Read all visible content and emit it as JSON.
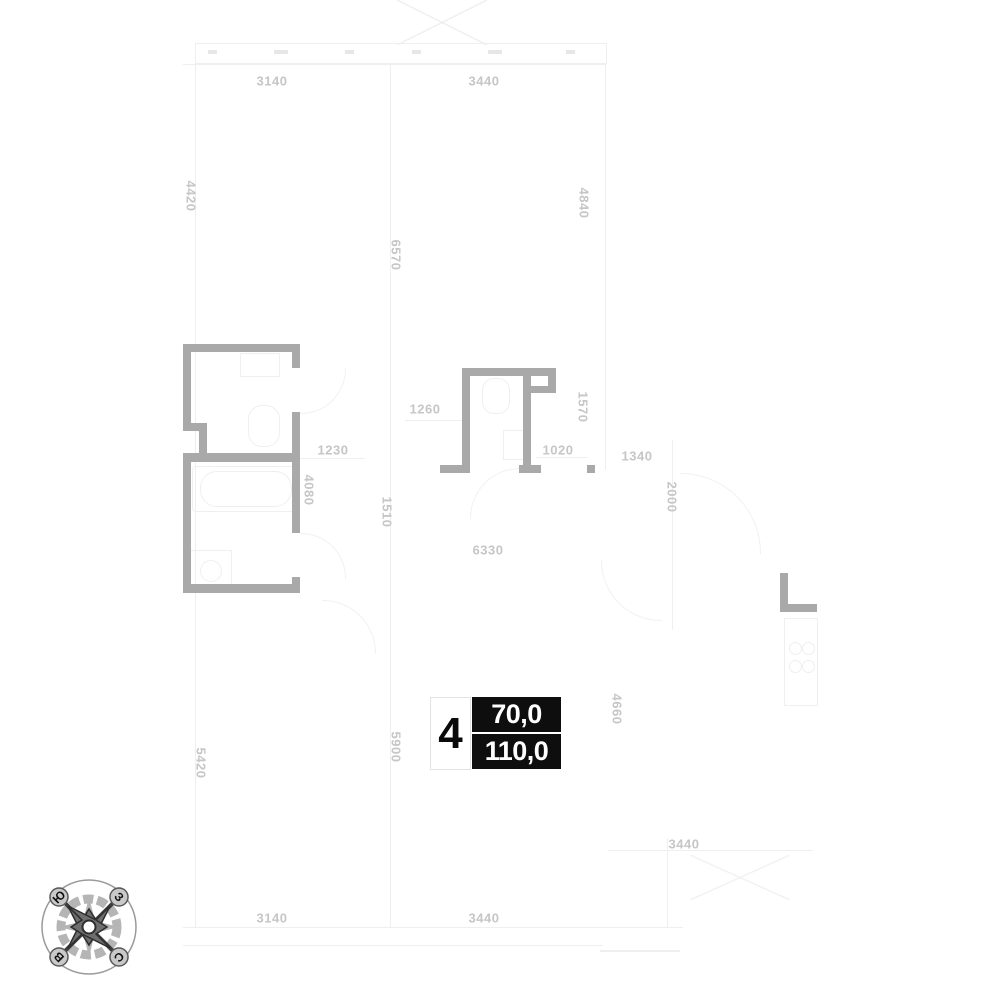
{
  "plan": {
    "type": "apartment-floor-plan",
    "badge": {
      "number": "4",
      "area_top": "70,0",
      "area_bottom": "110,0"
    },
    "wall_color": "#a9a9a9",
    "dimension_text_color": "#c6c6c6"
  },
  "compass": {
    "top_left": "Ю",
    "top_right": "З",
    "bottom_left": "В",
    "bottom_right": "С"
  },
  "dimensions": [
    {
      "text": "3140",
      "x": 272,
      "y": 81,
      "rot": 0
    },
    {
      "text": "3440",
      "x": 484,
      "y": 81,
      "rot": 0
    },
    {
      "text": "4420",
      "x": 191,
      "y": 196,
      "rot": 90
    },
    {
      "text": "4840",
      "x": 584,
      "y": 203,
      "rot": 90
    },
    {
      "text": "6570",
      "x": 396,
      "y": 255,
      "rot": 90
    },
    {
      "text": "1260",
      "x": 425,
      "y": 409,
      "rot": 0
    },
    {
      "text": "1570",
      "x": 583,
      "y": 407,
      "rot": 90
    },
    {
      "text": "1230",
      "x": 333,
      "y": 450,
      "rot": 0
    },
    {
      "text": "1020",
      "x": 558,
      "y": 450,
      "rot": 0
    },
    {
      "text": "1340",
      "x": 637,
      "y": 456,
      "rot": 0
    },
    {
      "text": "4080",
      "x": 309,
      "y": 490,
      "rot": 90
    },
    {
      "text": "2000",
      "x": 672,
      "y": 497,
      "rot": 90
    },
    {
      "text": "1510",
      "x": 387,
      "y": 512,
      "rot": 90
    },
    {
      "text": "6330",
      "x": 488,
      "y": 550,
      "rot": 0
    },
    {
      "text": "4660",
      "x": 617,
      "y": 709,
      "rot": 90
    },
    {
      "text": "5900",
      "x": 396,
      "y": 747,
      "rot": 90
    },
    {
      "text": "5420",
      "x": 201,
      "y": 763,
      "rot": 90
    },
    {
      "text": "3440",
      "x": 684,
      "y": 844,
      "rot": 0
    },
    {
      "text": "3140",
      "x": 272,
      "y": 918,
      "rot": 0
    },
    {
      "text": "3440",
      "x": 484,
      "y": 918,
      "rot": 0
    }
  ]
}
